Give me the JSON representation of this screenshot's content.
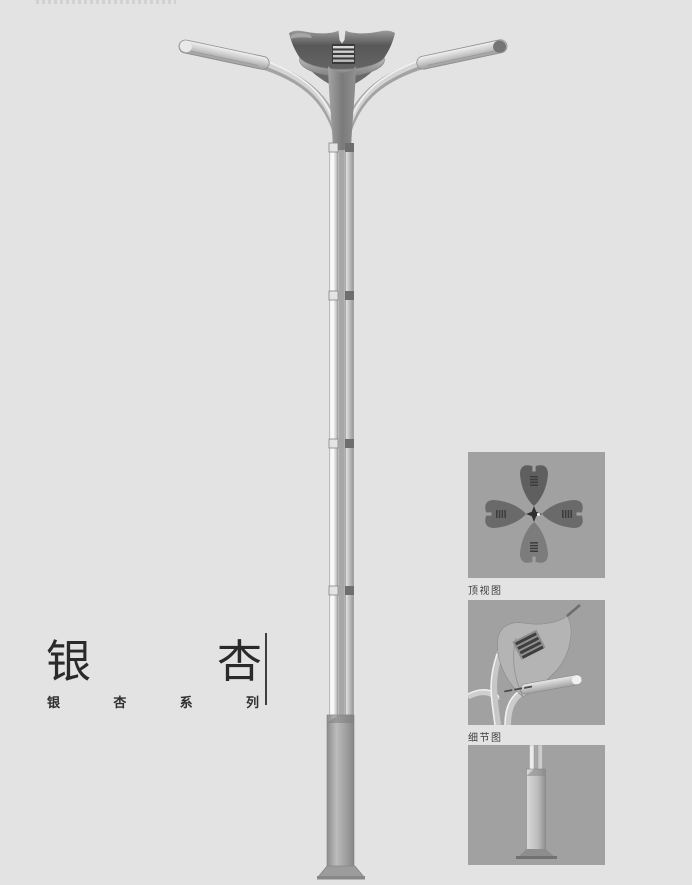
{
  "page": {
    "background_color": "#e3e3e3",
    "panel_background_color": "#a1a1a1",
    "title_color": "#2a2a2a",
    "label_color": "#3d3d3d"
  },
  "title_block": {
    "title": "银杏",
    "title_chars": [
      "银",
      "杏"
    ],
    "series_label": "银杏系列",
    "series_chars": [
      "银",
      "杏",
      "系",
      "列"
    ]
  },
  "detail_panels": [
    {
      "label": "顶视图"
    },
    {
      "label": "细节图"
    },
    {
      "label": ""
    }
  ],
  "illustration_colors": {
    "metal_light": "#f0f0f0",
    "metal_mid": "#c4c4c4",
    "metal_dark": "#5c5c5c",
    "base_gray": "#9b9b9b"
  }
}
